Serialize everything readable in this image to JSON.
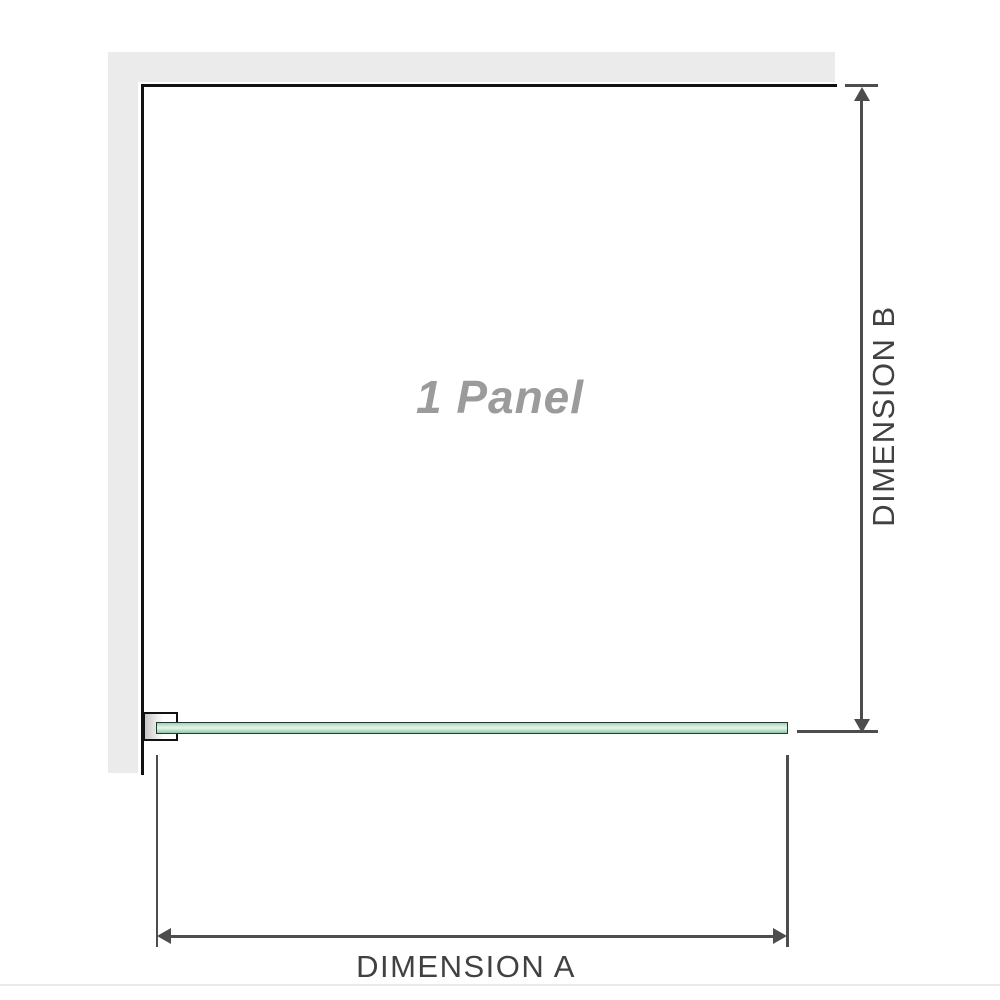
{
  "diagram": {
    "panel_label": "1 Panel",
    "dimension_a_label": "DIMENSION A",
    "dimension_b_label": "DIMENSION B",
    "colors": {
      "wall": "#ebebeb",
      "wall_edge": "#111111",
      "glass_edge": "#223b2d",
      "glass_fill": "#b9e0c8",
      "glass_highlight": "#e9f6ee",
      "dimension_line": "#4d4d4d",
      "label_text": "#414141",
      "panel_label_text": "#9b9b9b"
    }
  }
}
